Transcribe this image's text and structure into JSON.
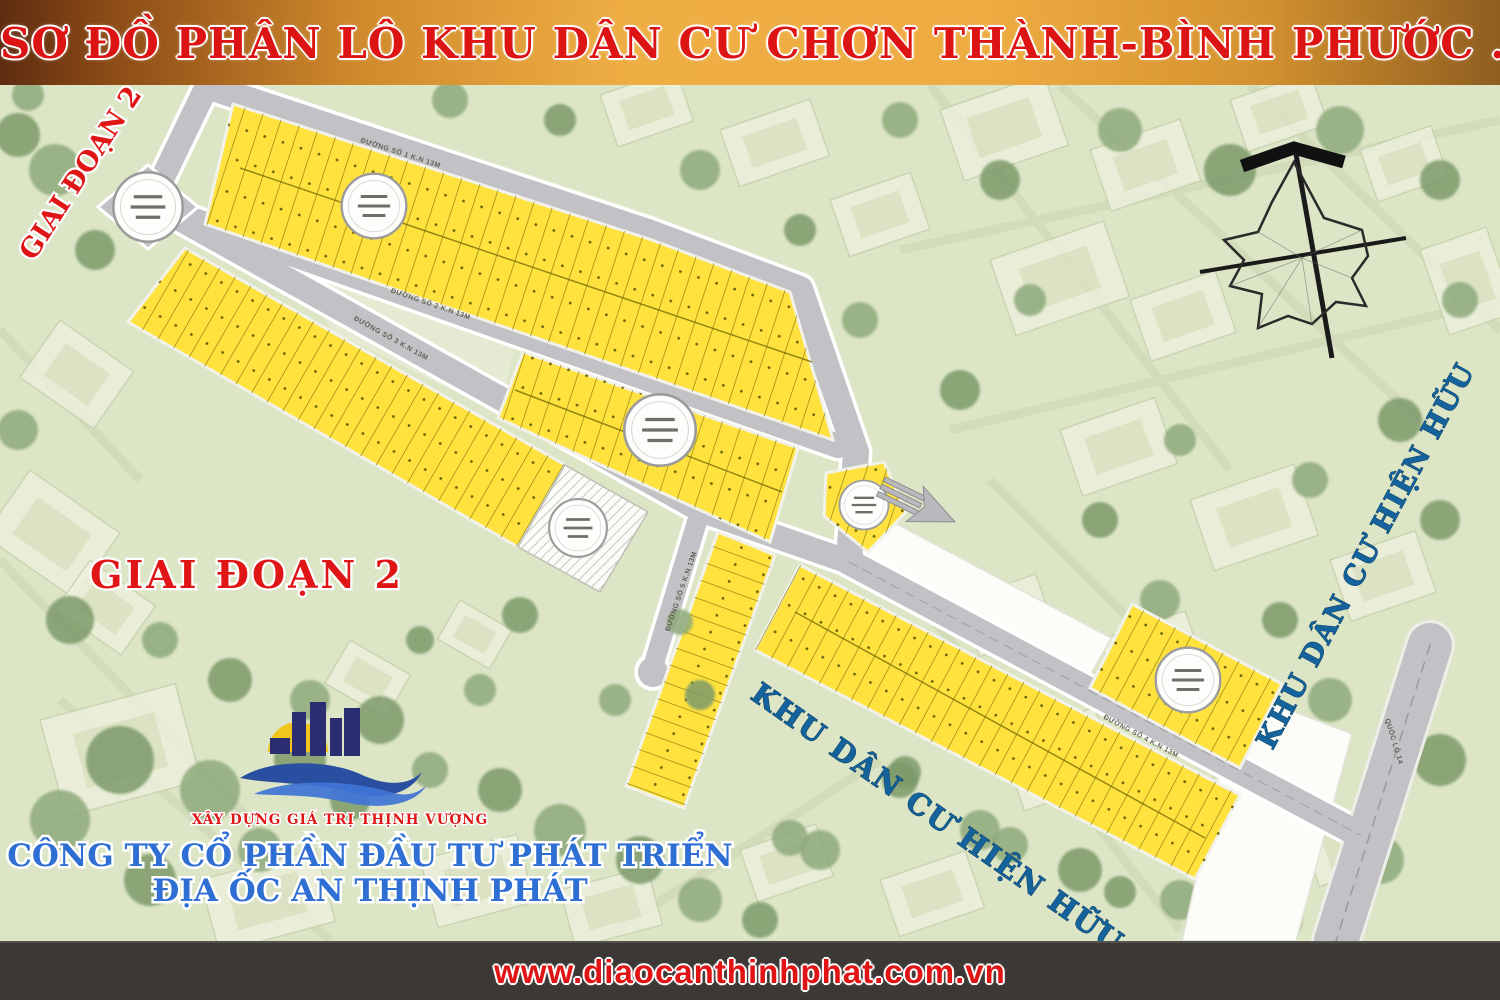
{
  "banner": {
    "title": "SƠ ĐỒ PHÂN LÔ KHU DÂN CƯ CHƠN THÀNH-BÌNH PHƯỚC ."
  },
  "map": {
    "phase_label_rotated": "GIAI ĐOẠN 2",
    "phase_label": "GIAI ĐOẠN 2",
    "existing_area_label_right": "KHU DÂN CƯ HIỆN HỮU",
    "existing_area_label_bottom": "KHU DÂN CƯ HIỆN HỮU",
    "road_labels": {
      "road1": "ĐƯỜNG SỐ 1 K.N 13M",
      "road2": "ĐƯỜNG SỐ 2 K.N 13M",
      "road3": "ĐƯỜNG SỐ 3 K.N 13M",
      "road4": "ĐƯỜNG SỐ 4 K.N 13M",
      "road5": "ĐƯỜNG SỐ 5 K.N 13M",
      "highway": "QUỐC LỘ 14"
    }
  },
  "company": {
    "slogan": "XÂY DỰNG GIÁ TRỊ THỊNH VƯỢNG",
    "name_line1": "CÔNG TY CỔ PHẦN ĐẦU TƯ PHÁT TRIỂN",
    "name_line2": "ĐỊA ỐC AN THỊNH PHÁT"
  },
  "footer": {
    "website": "www.diaocanthinhphat.com.vn"
  },
  "colors": {
    "accent_red": "#e01616",
    "brand_blue": "#2f6fd4",
    "label_blue": "#15639c",
    "plot_yellow": "#ffe23e",
    "road_grey": "#c2c2c6",
    "banner_orange": "#efae44",
    "footer_dark": "#3b3835"
  }
}
